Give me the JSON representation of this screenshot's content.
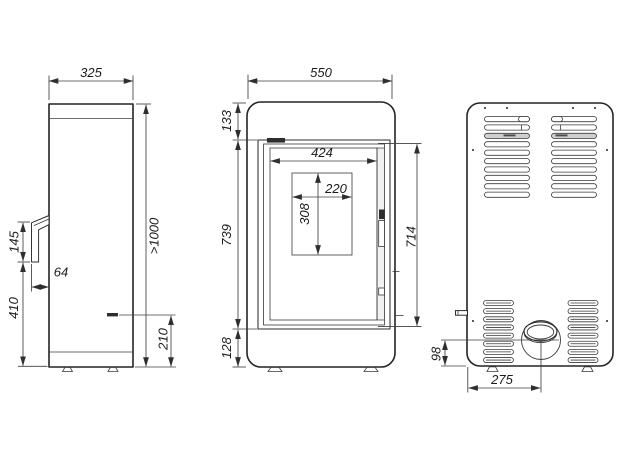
{
  "colors": {
    "background": "#ffffff",
    "line": "#2a2a2a",
    "text": "#1c1c1c"
  },
  "views": {
    "side": {
      "dims": {
        "width": "325",
        "handle_length": "145",
        "handle_depth": "64",
        "handle_to_floor": "410",
        "min_clearance": ">1000",
        "outlet_height": "210"
      }
    },
    "front": {
      "dims": {
        "width": "550",
        "top_to_glass": "133",
        "glass_width": "424",
        "window_width": "220",
        "window_height": "308",
        "glass_height_left": "739",
        "glass_height_right": "714",
        "glass_to_floor": "128"
      }
    },
    "back": {
      "dims": {
        "flue_height": "98",
        "flue_offset": "275"
      }
    }
  }
}
